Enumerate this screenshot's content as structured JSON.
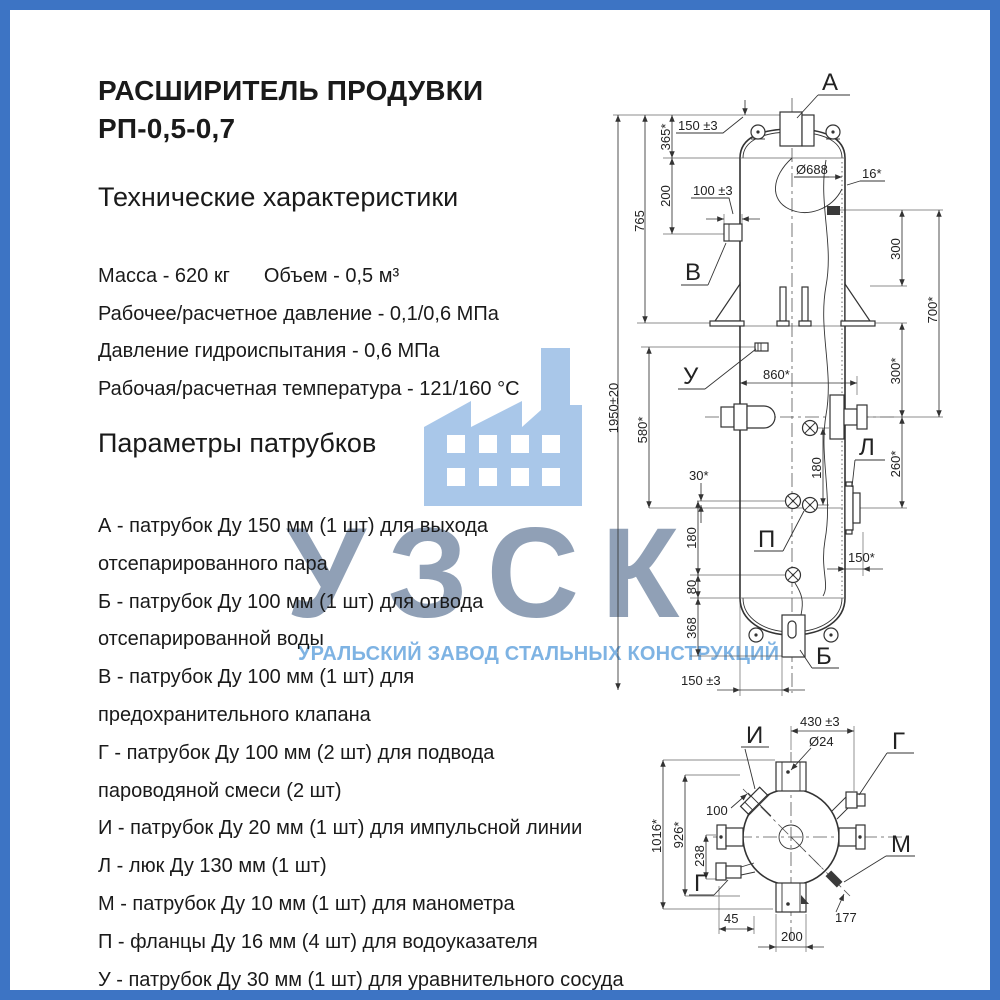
{
  "page": {
    "colors": {
      "border": "#3d74c4",
      "drawing_line": "#333333",
      "text": "#1a1a1a",
      "watermark_icon": "#a9c7e9",
      "watermark_abbr": "#8799b0",
      "watermark_name": "#68a6df"
    }
  },
  "title": {
    "line1": "РАСШИРИТЕЛЬ ПРОДУВКИ",
    "line2": "РП-0,5-0,7"
  },
  "specs": {
    "heading": "Технические характеристики",
    "mass": "Масса - 620 кг",
    "volume": "Объем - 0,5 м³",
    "rows": [
      "Рабочее/расчетное давление - 0,1/0,6 МПа",
      "Давление гидроиспытания - 0,6 МПа",
      "Рабочая/расчетная температура - 121/160 °С"
    ]
  },
  "nozzles": {
    "heading": "Параметры патрубков",
    "items": [
      {
        "lines": [
          "А - патрубок Ду 150 мм (1 шт) для выхода",
          "отсепарированного пара"
        ]
      },
      {
        "lines": [
          "Б - патрубок Ду 100 мм (1 шт)  для отвода",
          "отсепарированной воды"
        ]
      },
      {
        "lines": [
          "В - патрубок Ду 100 мм (1 шт) для",
          "предохранительного клапана"
        ]
      },
      {
        "lines": [
          "Г - патрубок Ду 100 мм (2 шт) для подвода",
          "пароводяной смеси (2 шт)"
        ]
      },
      {
        "lines": [
          "И - патрубок Ду 20 мм (1 шт) для импульсной линии"
        ]
      },
      {
        "lines": [
          "Л - люк Ду 130 мм (1 шт)"
        ]
      },
      {
        "lines": [
          "М - патрубок Ду 10 мм (1 шт) для манометра"
        ]
      },
      {
        "lines": [
          "П - фланцы Ду 16 мм (4 шт) для водоуказателя"
        ]
      },
      {
        "lines": [
          "У - патрубок Ду 30 мм (1 шт) для уравнительного сосуда"
        ]
      }
    ]
  },
  "watermark": {
    "abbr": "УЗСК",
    "full_name": "УРАЛЬСКИЙ ЗАВОД СТАЛЬНЫХ КОНСТРУКЦИЙ",
    "icon": "factory-icon"
  },
  "drawing": {
    "front_view": {
      "part_labels": {
        "a": "А",
        "v": "В",
        "u": "У",
        "l": "Л",
        "p": "П",
        "b": "Б"
      },
      "dims": {
        "overall": "1950±20",
        "upper": "765",
        "head": "365*",
        "neck": "200",
        "mid": "580*",
        "nozzle_a": "150 ±3",
        "nozzle_v": "100 ±3",
        "inner_dia": "Ø688",
        "wall": "16*",
        "width": "860*",
        "right_upper": "300",
        "right_total": "700*",
        "right_mid": "300*",
        "right_lower": "260*",
        "gauge_right": "180",
        "gauge_offset": "30*",
        "gauge_left": "180",
        "lower": "80",
        "bottom_head": "368",
        "manhole": "150*",
        "bottom_offset": "150 ±3"
      }
    },
    "top_view": {
      "part_labels": {
        "i": "И",
        "g_right": "Г",
        "m": "М",
        "g_left": "Г"
      },
      "dims": {
        "flange": "430 ±3",
        "hole": "Ø24",
        "impulse": "100",
        "overall": "1016*",
        "body": "926*",
        "offset": "238",
        "left": "45",
        "bottom": "200",
        "diagonal": "177"
      }
    }
  }
}
